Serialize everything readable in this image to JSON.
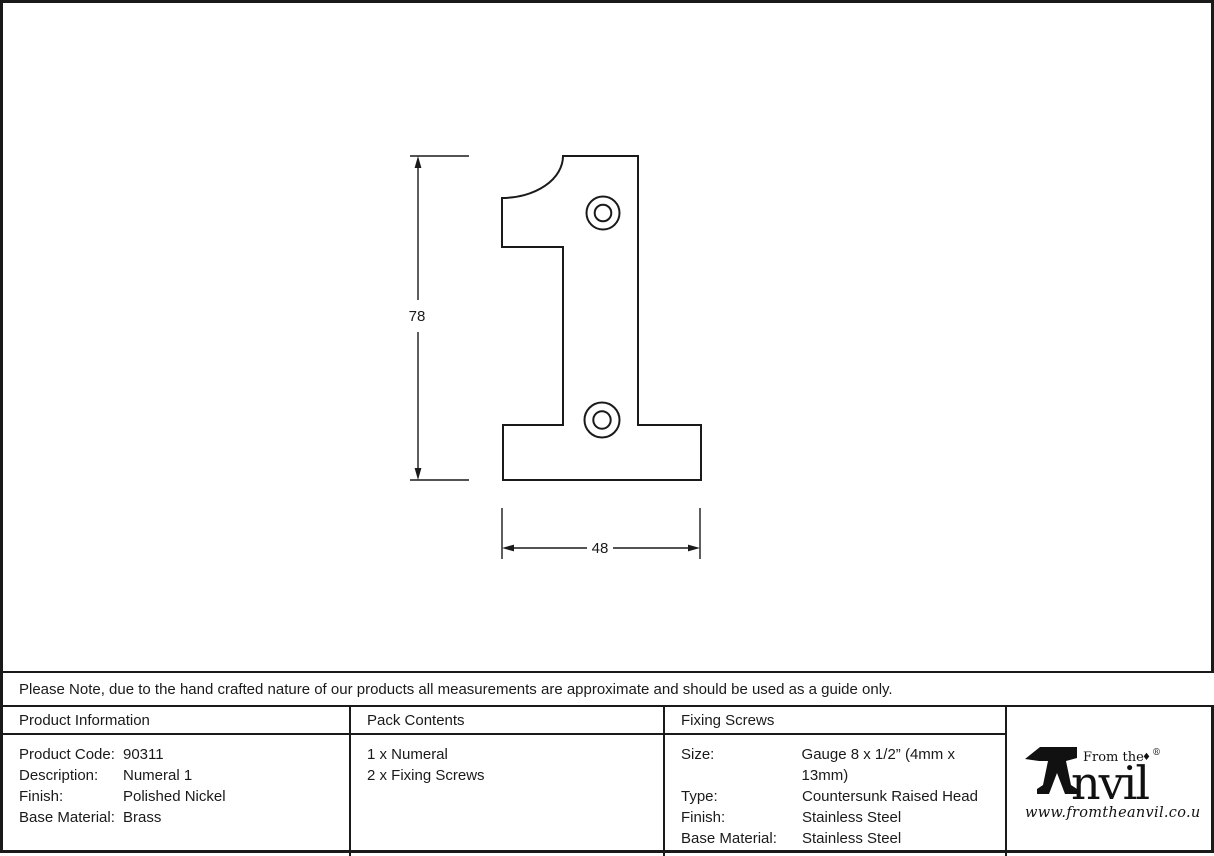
{
  "note": {
    "text": "Please Note, due to the hand crafted nature of our products all measurements are approximate and should be used as a guide only."
  },
  "drawing": {
    "height_dim": "78",
    "width_dim": "48"
  },
  "table": {
    "product_information": {
      "header": "Product Information",
      "rows": [
        {
          "label": "Product Code:",
          "value": "90311"
        },
        {
          "label": "Description:",
          "value": "Numeral 1"
        },
        {
          "label": "Finish:",
          "value": "Polished Nickel"
        },
        {
          "label": "Base Material:",
          "value": "Brass"
        }
      ]
    },
    "pack_contents": {
      "header": "Pack Contents",
      "items": [
        "1 x Numeral",
        "2 x Fixing Screws"
      ]
    },
    "fixing_screws": {
      "header": "Fixing Screws",
      "rows": [
        {
          "label": "Size:",
          "value": "Gauge 8 x 1/2” (4mm x 13mm)"
        },
        {
          "label": "Type:",
          "value": "Countersunk Raised Head"
        },
        {
          "label": "Finish:",
          "value": "Stainless Steel"
        },
        {
          "label": "Base Material:",
          "value": "Stainless Steel"
        }
      ]
    }
  },
  "logo": {
    "from_the": "From the",
    "diamond": "♦",
    "name_rest": "nvil",
    "registered": "®",
    "url": "www.fromtheanvil.co.uk"
  },
  "colors": {
    "ink": "#1a1a1a",
    "background": "#ffffff"
  }
}
